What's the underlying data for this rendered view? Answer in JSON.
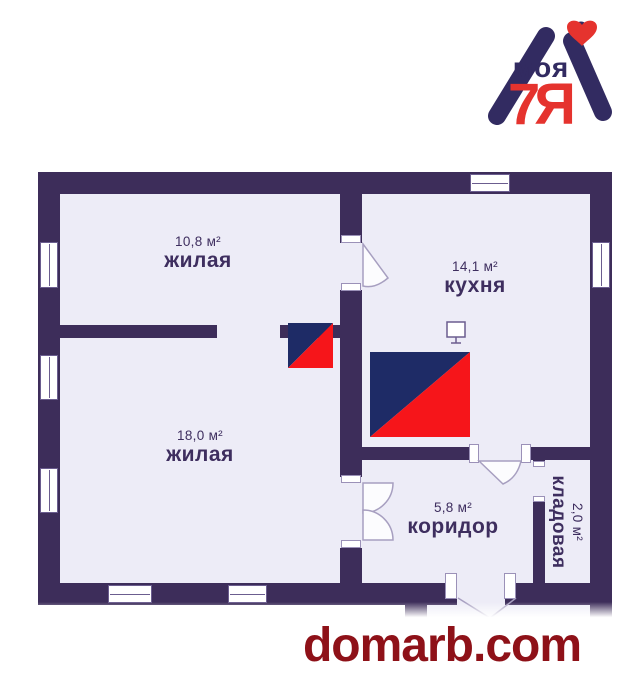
{
  "logo": {
    "brand_top": "моя",
    "brand_main": "7Я",
    "heart_icon": "heart-icon",
    "navy": "#322b61",
    "red": "#e5332e"
  },
  "plan": {
    "rooms": [
      {
        "id": "living-small",
        "area": "10,8 м²",
        "label": "жилая"
      },
      {
        "id": "living-large",
        "area": "18,0 м²",
        "label": "жилая"
      },
      {
        "id": "kitchen",
        "area": "14,1 м²",
        "label": "кухня"
      },
      {
        "id": "corridor",
        "area": "5,8 м²",
        "label": "коридор"
      },
      {
        "id": "storage",
        "area": "2,0 м²",
        "label": "кладовая"
      }
    ],
    "icons": {
      "kitchen_appliance": "tv-icon"
    },
    "colors": {
      "wall": "#3d2d5a",
      "room_fill": "#edecf7",
      "watermark_navy": "#1e2b66",
      "watermark_red": "#f6151a"
    }
  },
  "footer": {
    "site": "domarb.com",
    "color": "#8e1118"
  }
}
